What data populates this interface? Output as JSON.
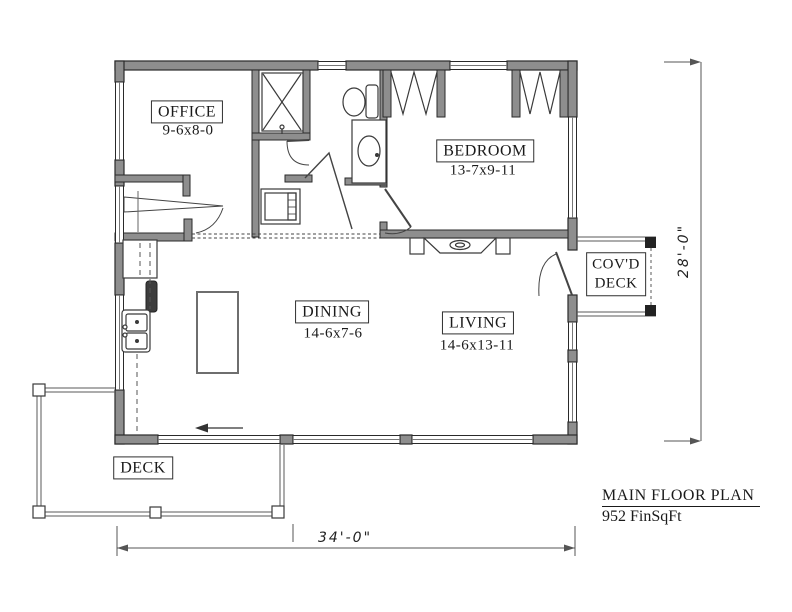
{
  "colors": {
    "wall_fill": "#8e8e8e",
    "wall_edge": "#2a2a2a",
    "thin_line": "#555555",
    "text": "#1a1a1a",
    "background": "#ffffff"
  },
  "rooms": {
    "office": {
      "label": "OFFICE",
      "size": "9-6x8-0"
    },
    "bedroom": {
      "label": "BEDROOM",
      "size": "13-7x9-11"
    },
    "dining": {
      "label": "DINING",
      "size": "14-6x7-6"
    },
    "living": {
      "label": "LIVING",
      "size": "14-6x13-11"
    }
  },
  "outdoor": {
    "covd_line1": "COV'D",
    "covd_line2": "DECK",
    "deck": "DECK"
  },
  "dimensions": {
    "width": "34'-0\"",
    "height": "28'-0\""
  },
  "title_block": {
    "title": "MAIN FLOOR PLAN",
    "area": "952 FinSqFt"
  },
  "fixtures": [
    "shower",
    "toilet",
    "vanity-sink",
    "washer-dryer",
    "refrigerator",
    "range",
    "kitchen-sink",
    "kitchen-island",
    "fireplace"
  ]
}
